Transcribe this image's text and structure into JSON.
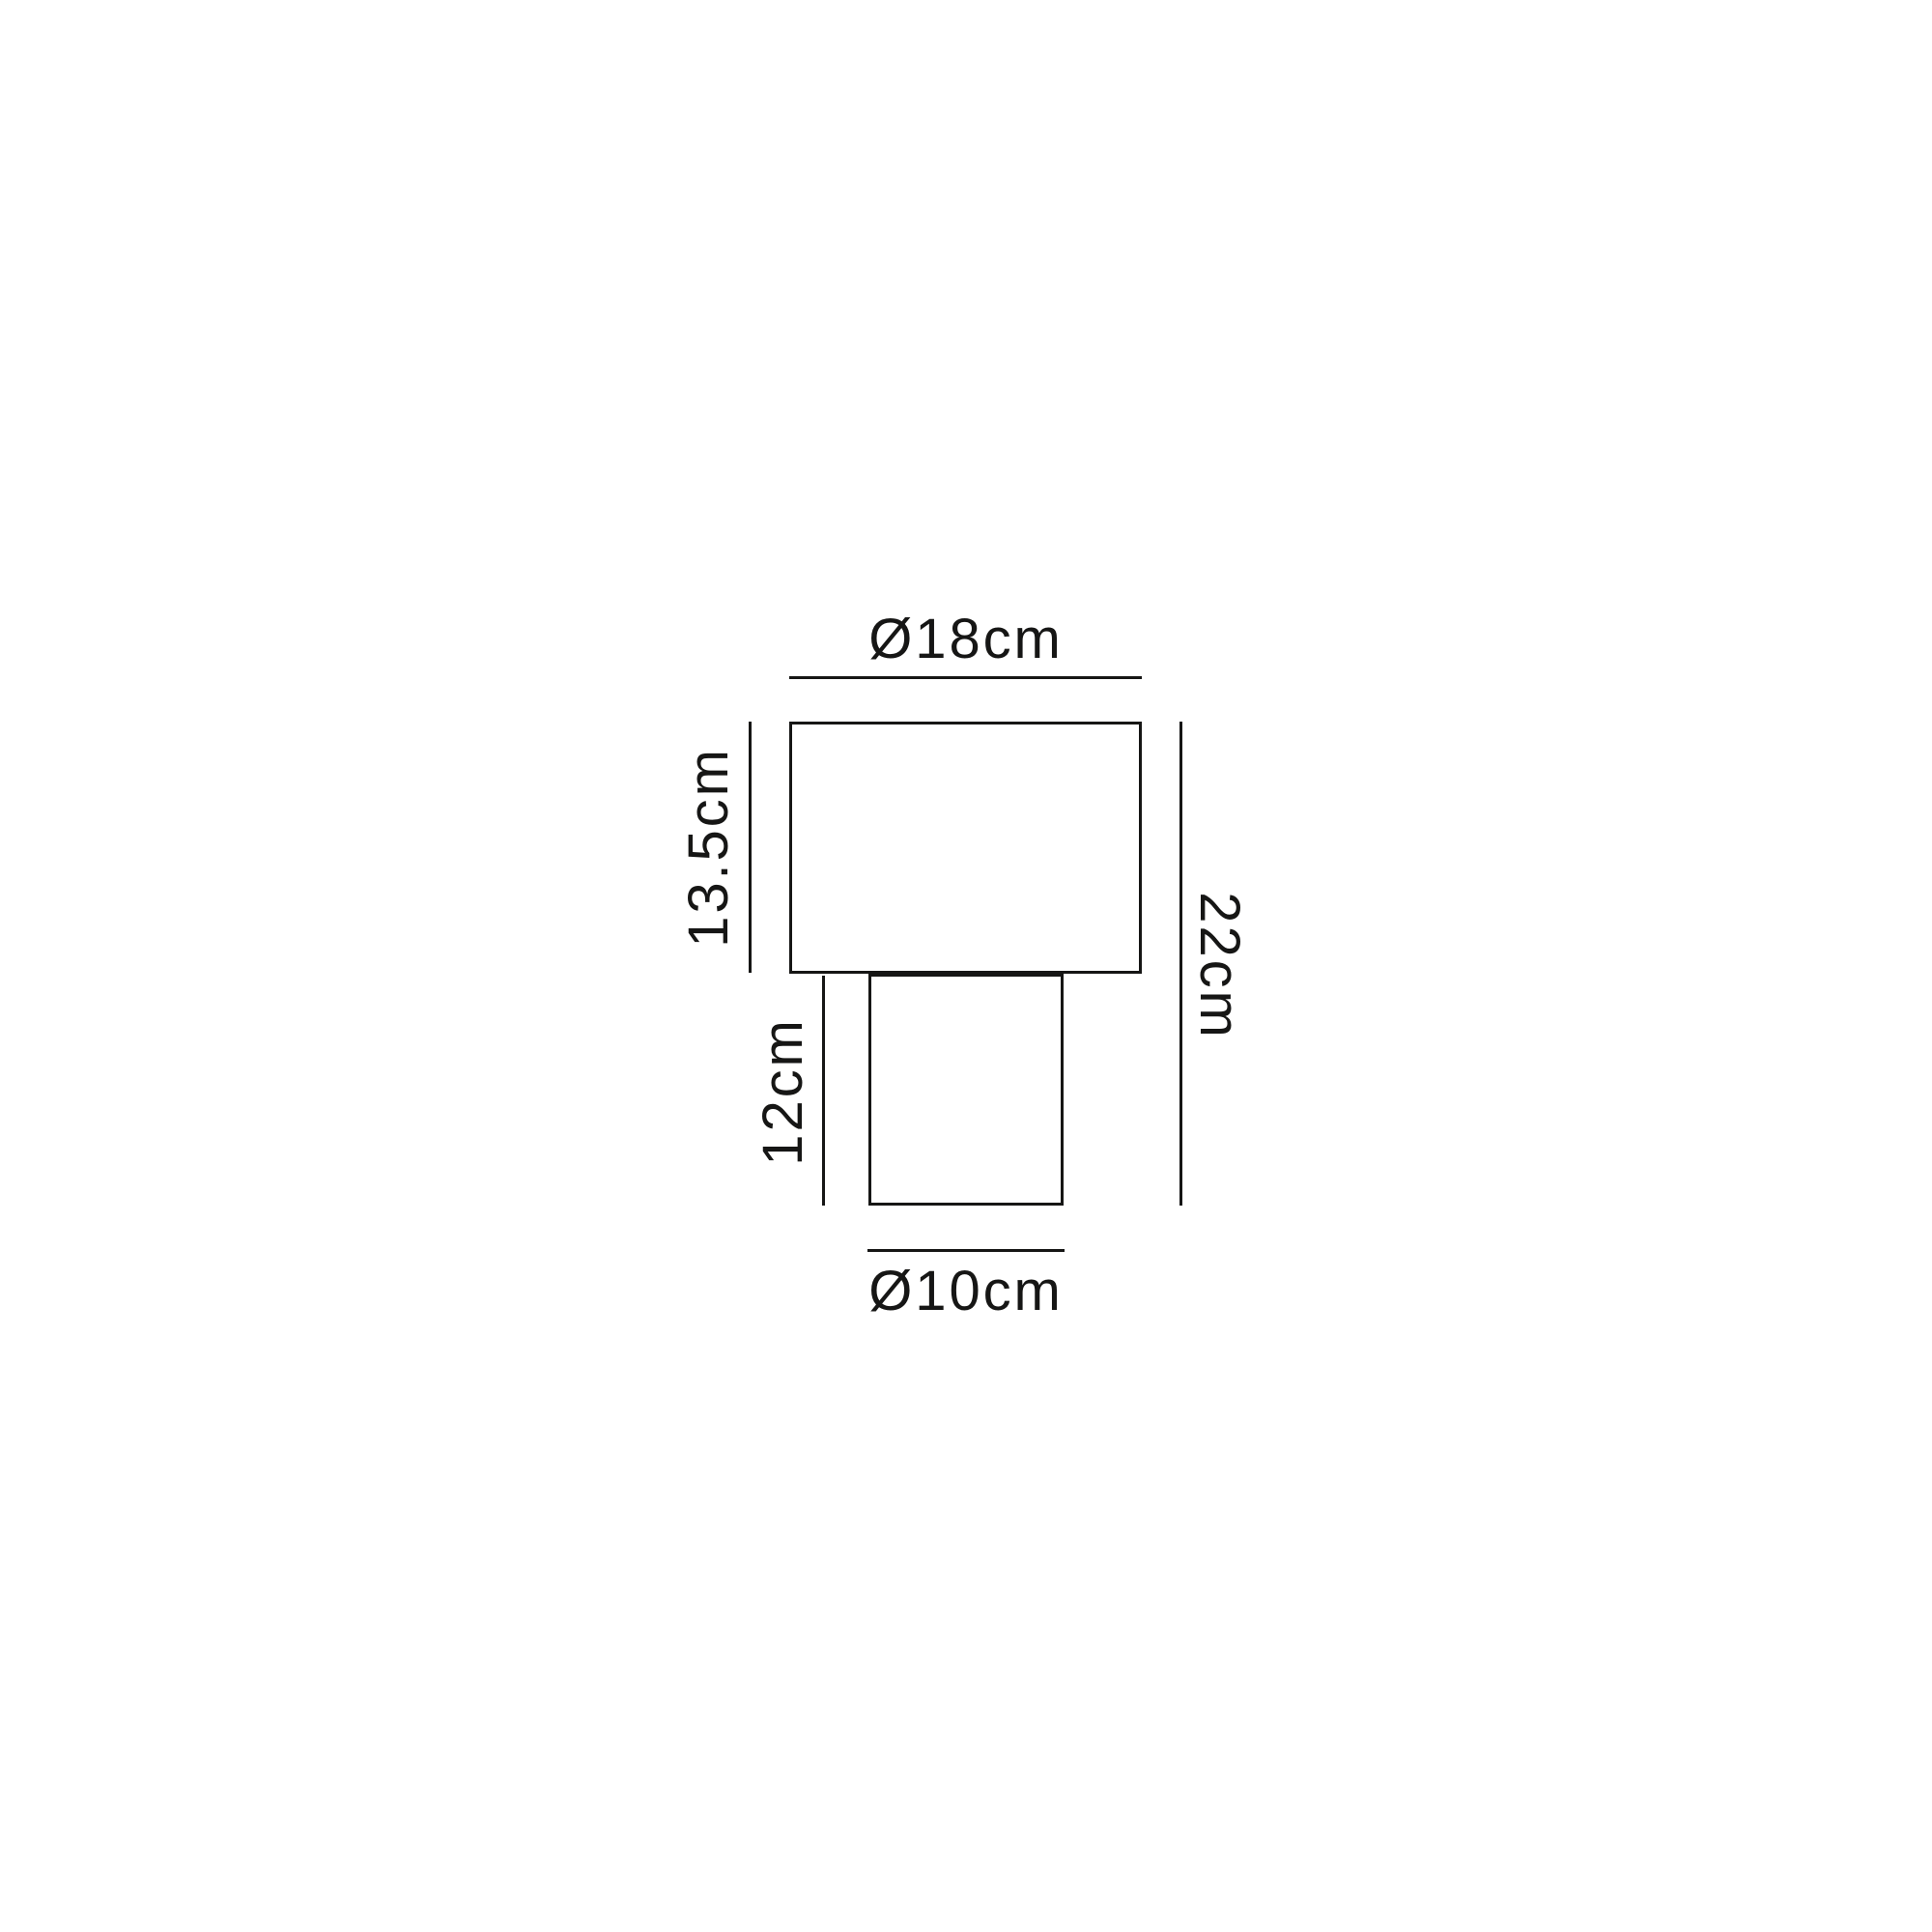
{
  "diagram": {
    "type": "dimension-drawing",
    "subject": "table-lamp-line-drawing",
    "colors": {
      "line": "#161615",
      "background": "#ffffff"
    },
    "labels": {
      "shade_diameter": "Ø18cm",
      "shade_height": "13.5cm",
      "base_height": "12cm",
      "total_height": "22cm",
      "base_diameter": "Ø10cm"
    }
  }
}
